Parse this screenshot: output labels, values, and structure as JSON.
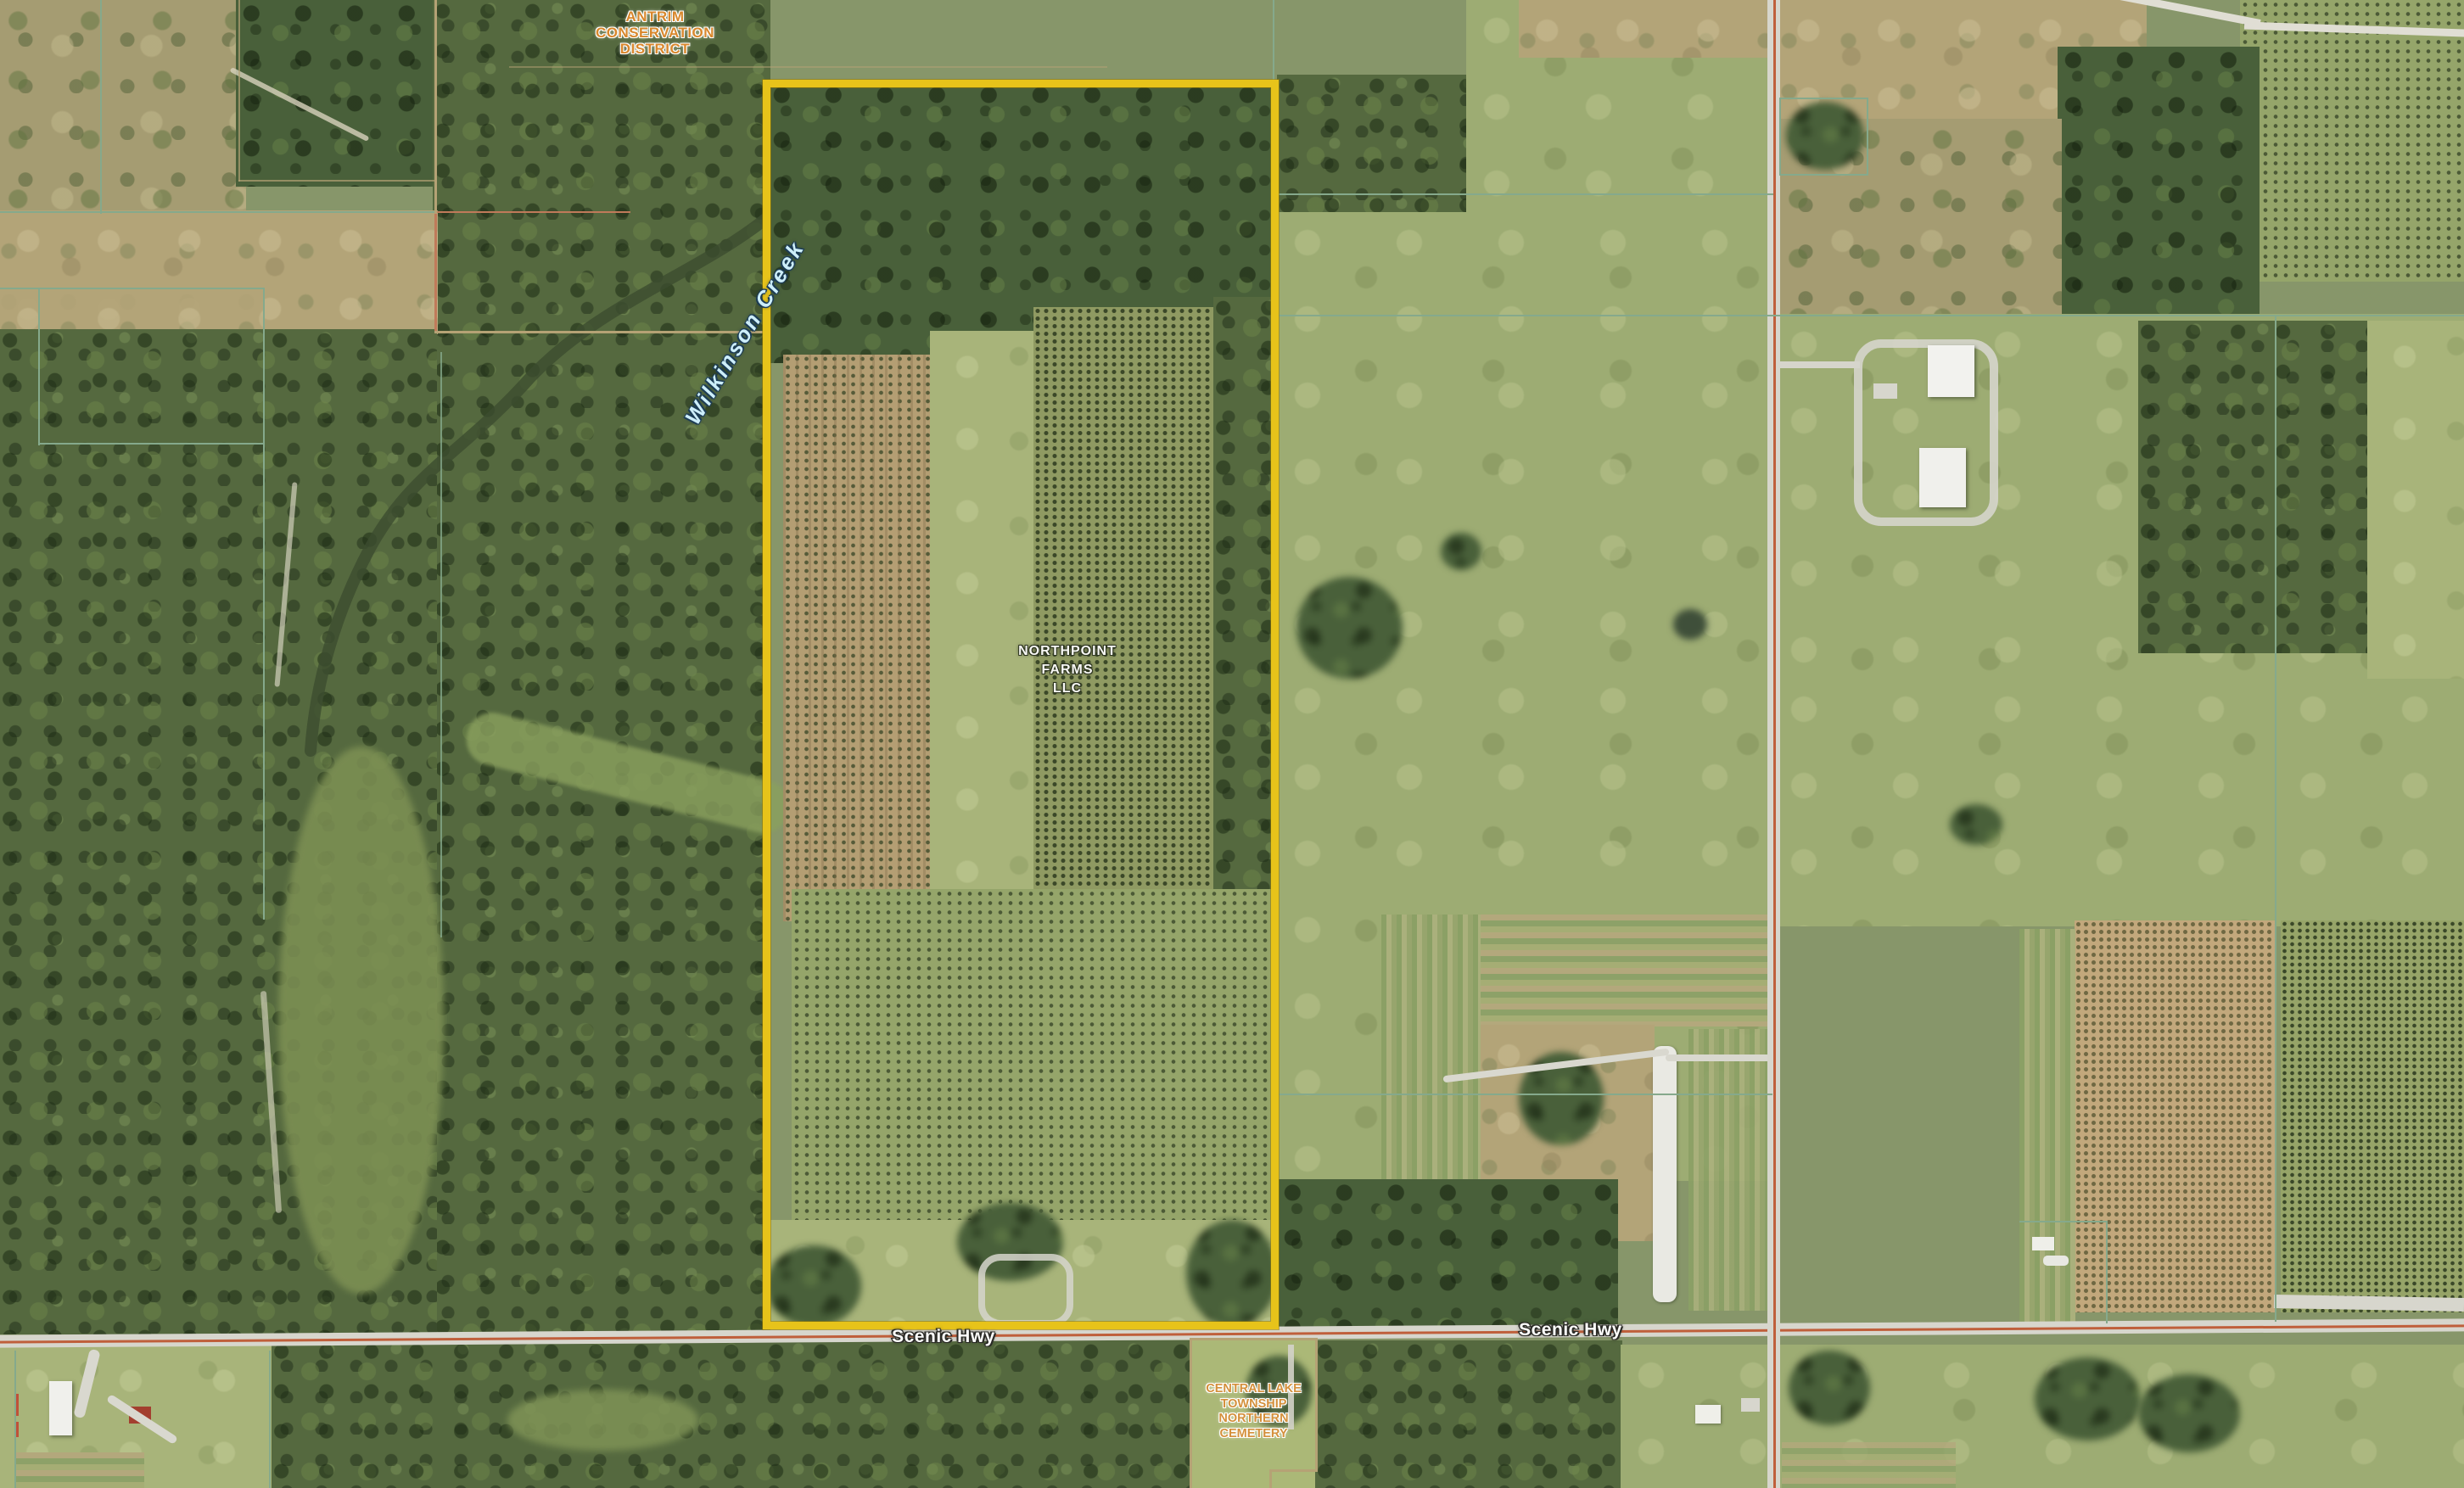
{
  "map": {
    "title": "Aerial parcel map",
    "labels": {
      "antrim": {
        "l1": "ANTRIM",
        "l2": "CONSERVATION",
        "l3": "DISTRICT"
      },
      "creek": {
        "name": "Wilkinson Creek"
      },
      "northpoint": {
        "l1": "NORTHPOINT",
        "l2": "FARMS",
        "l3": "LLC"
      },
      "scenic_west": "Scenic Hwy",
      "scenic_east": "Scenic Hwy",
      "cemetery": {
        "l1": "CENTRAL LAKE",
        "l2": "TOWNSHIP",
        "l3": "NORTHERN",
        "l4": "CEMETERY"
      }
    },
    "colors": {
      "subject_parcel_boundary": "#e7c31a",
      "road_centerline": "#bf5f3b",
      "parcel_line_teal": "#85a98c",
      "parcel_line_tan": "#b5a275",
      "creek_label": "#cdeef9",
      "poi_label_orange": "#d8872c",
      "white_label": "#f8f8f5"
    },
    "features": {
      "subject_parcel": "NORTHPOINT FARMS LLC parcel outlined in yellow",
      "roads": [
        "Scenic Hwy"
      ],
      "water": [
        "Wilkinson Creek"
      ],
      "points_of_interest": [
        "Antrim Conservation District",
        "Central Lake Township Northern Cemetery"
      ]
    }
  }
}
